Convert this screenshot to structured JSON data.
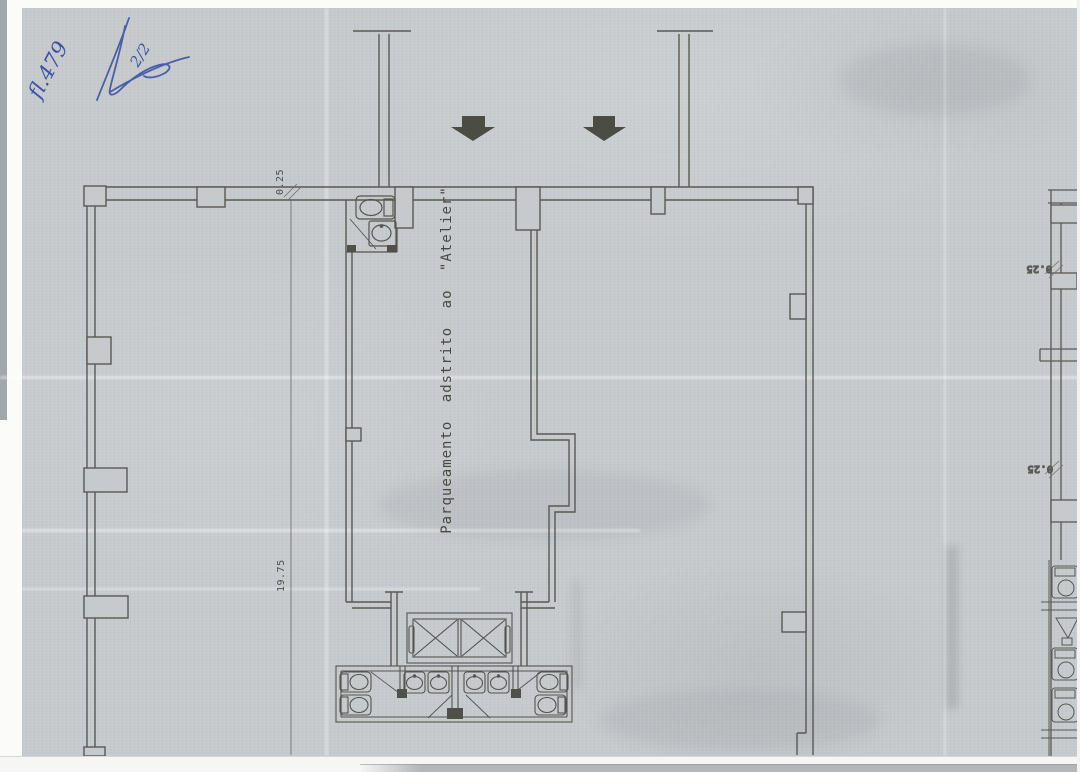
{
  "annotations": {
    "page_ref": "fl.479",
    "page_fraction": "2/2"
  },
  "plan": {
    "room_label": "Parqueamento adstrito ao \"Atelier\"",
    "dimensions": {
      "top_offset": "0.25",
      "left_length": "19.75",
      "right_upper_offset": "0.25",
      "right_lower_offset": "0.25"
    },
    "icons": {
      "entrance_arrow": "solid-down-arrow",
      "toilet": "oval-bowl-with-tank",
      "sink": "basin-with-tap-dot",
      "elevator_shaft": "rect-with-x-cross",
      "door_swing": "diagonal-leaf-line"
    }
  },
  "colors": {
    "paper": "#c6cacd",
    "line_ink": "#50504b",
    "handwriting_ink": "#3d54a3",
    "arrow_fill": "#4b4c43",
    "margin_white": "#f4f4f2",
    "bottom_bar": "#b3b7ba"
  }
}
